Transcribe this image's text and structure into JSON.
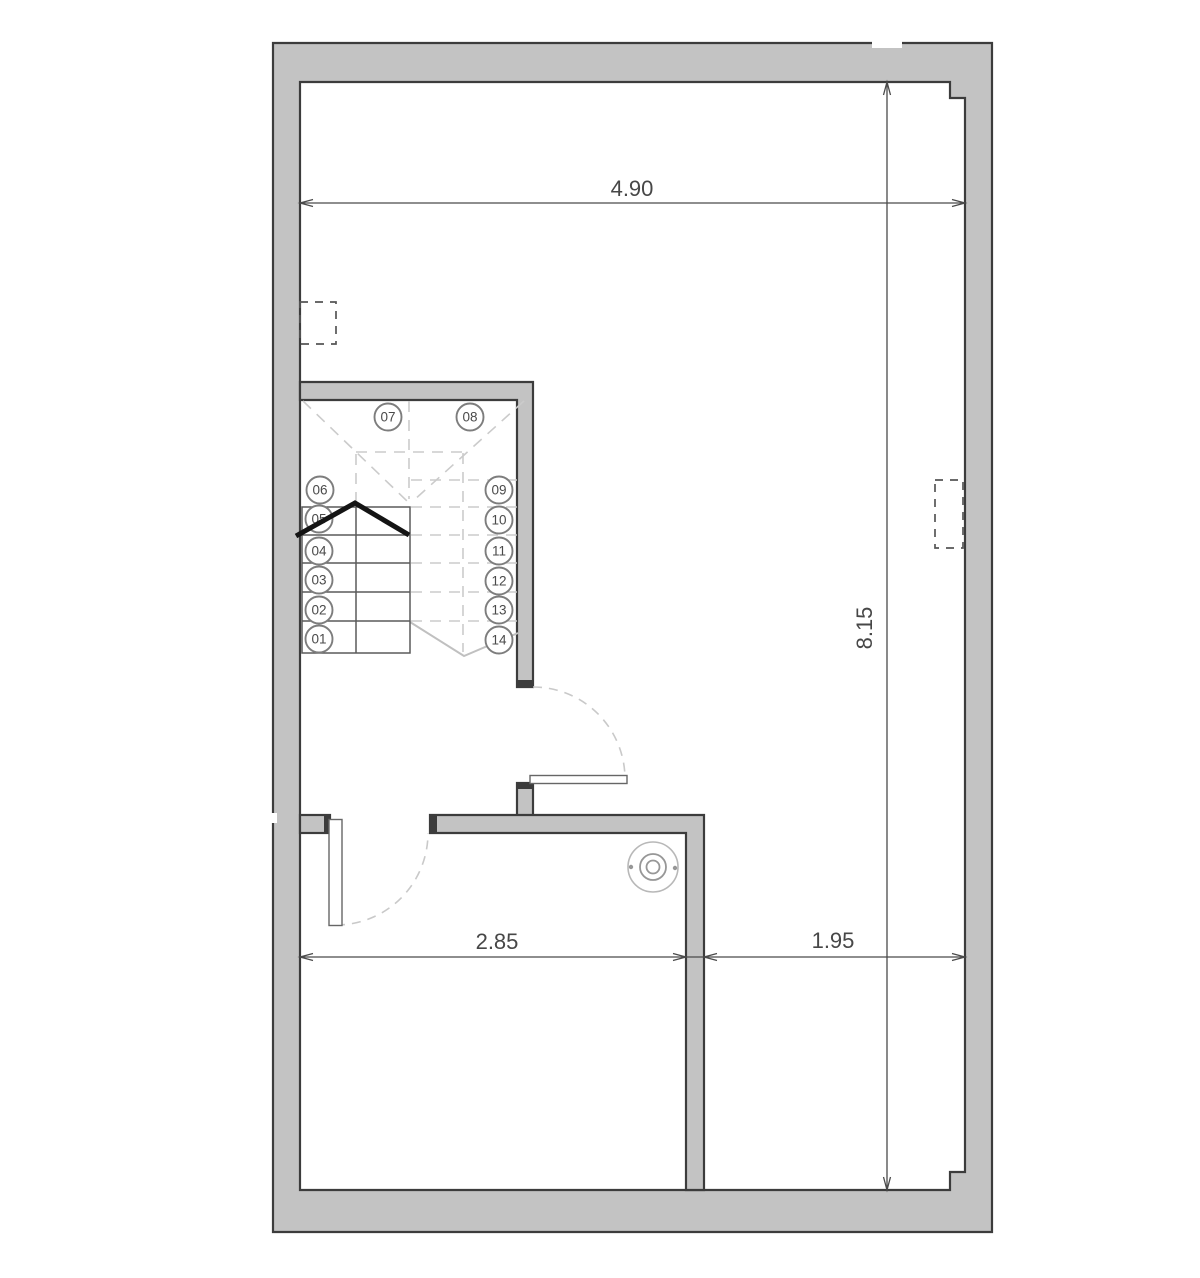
{
  "dimensions": {
    "top_width": "4.90",
    "right_height": "8.15",
    "bottom_left_width": "2.85",
    "bottom_right_width": "1.95"
  },
  "stairs": {
    "steps": [
      {
        "label": "01"
      },
      {
        "label": "02"
      },
      {
        "label": "03"
      },
      {
        "label": "04"
      },
      {
        "label": "05"
      },
      {
        "label": "06"
      },
      {
        "label": "07"
      },
      {
        "label": "08"
      },
      {
        "label": "09"
      },
      {
        "label": "10"
      },
      {
        "label": "11"
      },
      {
        "label": "12"
      },
      {
        "label": "13"
      },
      {
        "label": "14"
      }
    ]
  },
  "colors": {
    "wall_fill": "#c3c3c3",
    "wall_edge": "#3c3c3c",
    "dimension_line": "#4a4a4a",
    "hidden_line": "#cbcbcb",
    "break_line": "#141414"
  }
}
